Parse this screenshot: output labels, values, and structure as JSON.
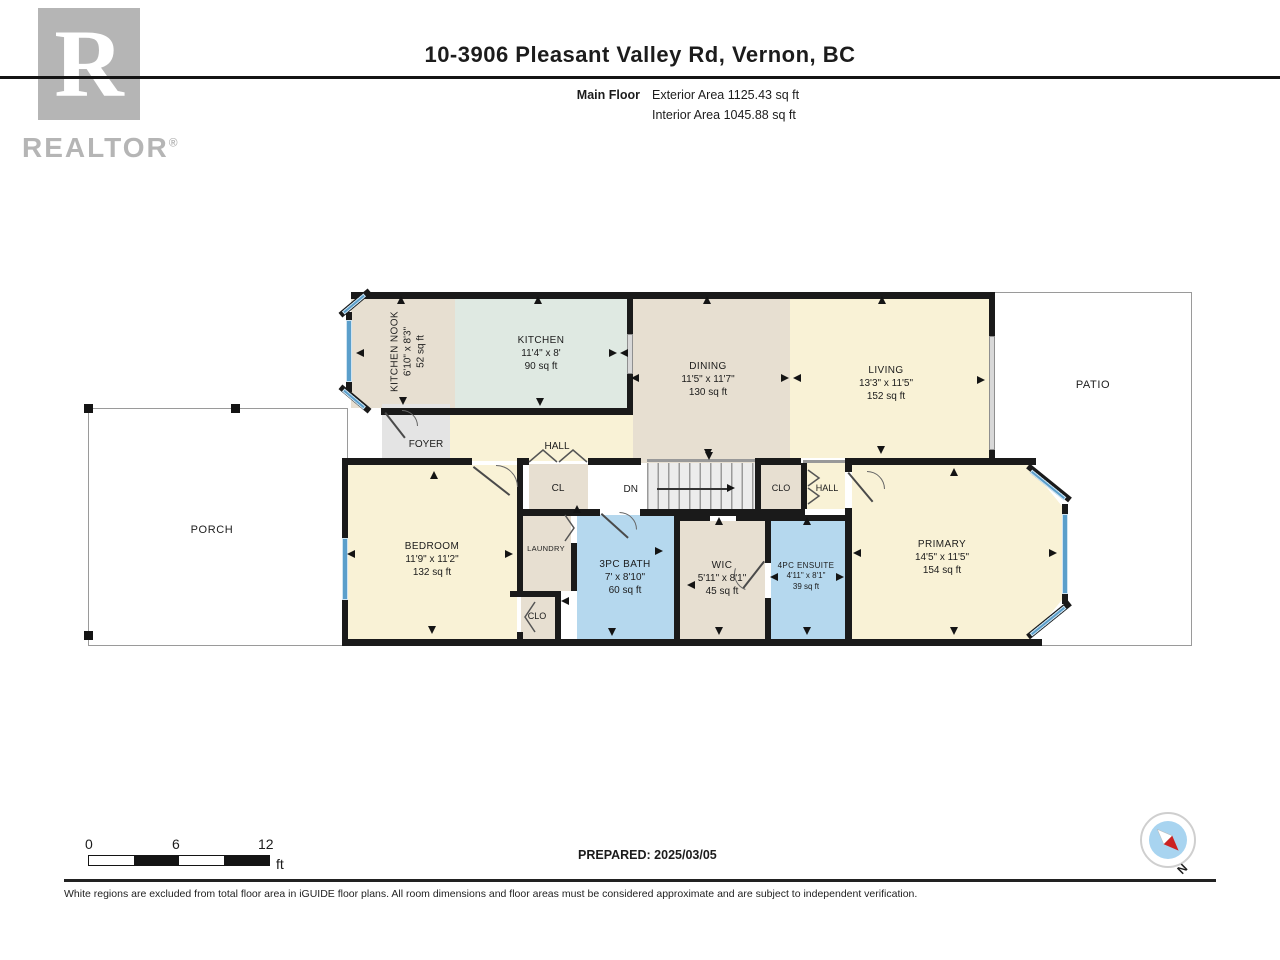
{
  "header": {
    "logo_letter": "R",
    "logo_word": "REALTOR",
    "logo_reg": "®",
    "title": "10-3906 Pleasant Valley Rd, Vernon, BC",
    "floor_label": "Main Floor",
    "exterior_area": "Exterior Area 1125.43 sq ft",
    "interior_area": "Interior Area 1045.88 sq ft"
  },
  "rooms": {
    "kitchen_nook": {
      "name": "KITCHEN NOOK",
      "dims": "6'10\" x 8'3\"",
      "area": "52 sq ft"
    },
    "kitchen": {
      "name": "KITCHEN",
      "dims": "11'4\" x 8'",
      "area": "90 sq ft"
    },
    "dining": {
      "name": "DINING",
      "dims": "11'5\" x 11'7\"",
      "area": "130 sq ft"
    },
    "living": {
      "name": "LIVING",
      "dims": "13'3\" x 11'5\"",
      "area": "152 sq ft"
    },
    "patio": {
      "name": "PATIO"
    },
    "porch": {
      "name": "PORCH"
    },
    "foyer": {
      "name": "FOYER"
    },
    "hall_upper": {
      "name": "HALL"
    },
    "closet_hall": {
      "name": "CL"
    },
    "stairs": {
      "name": "DN"
    },
    "closet_mid": {
      "name": "CLO"
    },
    "hall_right": {
      "name": "HALL"
    },
    "bedroom": {
      "name": "BEDROOM",
      "dims": "11'9\" x 11'2\"",
      "area": "132 sq ft"
    },
    "laundry": {
      "name": "LAUNDRY"
    },
    "closet_bedroom": {
      "name": "CLO"
    },
    "bath": {
      "name": "3PC BATH",
      "dims": "7' x 8'10\"",
      "area": "60 sq ft"
    },
    "wic": {
      "name": "WIC",
      "dims": "5'11\" x 8'1\"",
      "area": "45 sq ft"
    },
    "ensuite": {
      "name": "4PC ENSUITE",
      "dims": "4'11\" x 8'1\"",
      "area": "39 sq ft"
    },
    "primary": {
      "name": "PRIMARY",
      "dims": "14'5\" x 11'5\"",
      "area": "154 sq ft"
    }
  },
  "scale_bar": {
    "ticks": [
      "0",
      "6",
      "12"
    ],
    "unit": "ft"
  },
  "footer": {
    "prepared": "PREPARED: 2025/03/05",
    "disclaimer": "White regions are excluded from total floor area in iGUIDE floor plans. All room dimensions and floor areas must be considered approximate and are subject to independent verification.",
    "compass_label": "N"
  },
  "colors": {
    "wall": "#1a1a1a",
    "tan": "#e7dfd1",
    "mint": "#dfe9e2",
    "cream": "#f9f2d6",
    "bluerm": "#b5d8ee",
    "window": "#5b9fcb",
    "logogray": "#b5b5b5",
    "compassblue": "#a8d4f0",
    "compassred": "#cc2222"
  }
}
